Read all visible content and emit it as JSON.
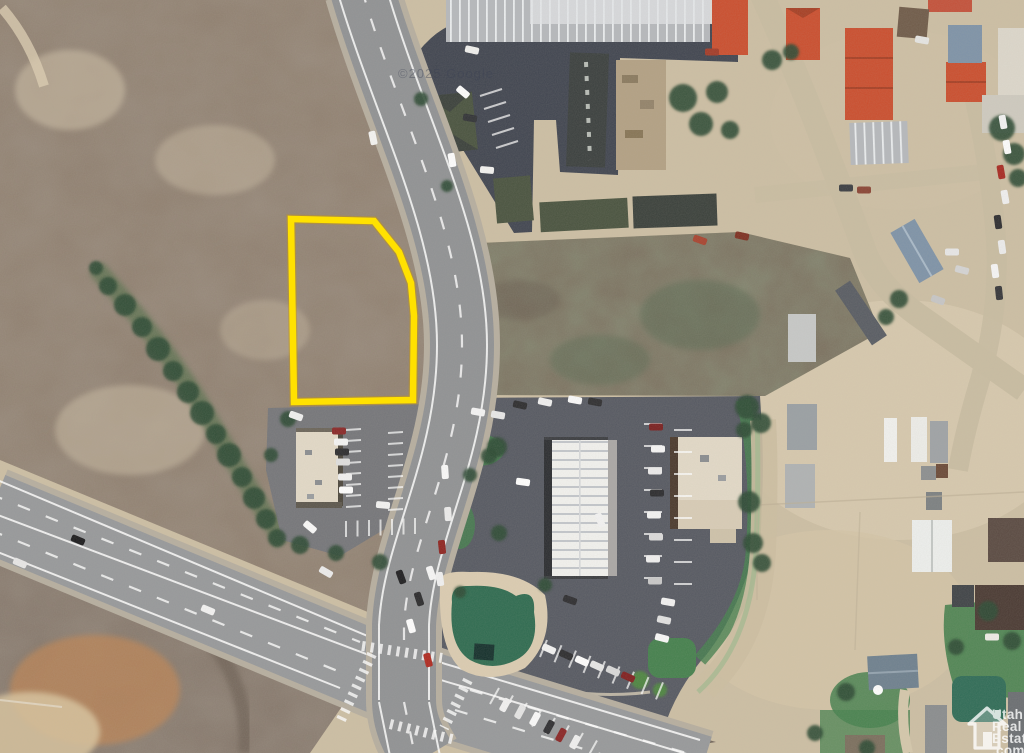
{
  "meta": {
    "type": "satellite-aerial-photo",
    "description": "Aerial real-estate listing photo of a small town: vacant lot outlined in yellow beside a curving main street, a divided highway at lower left, commercial buildings and red-roofed structures"
  },
  "colors": {
    "base_dirt": "#cdbfa4",
    "dirt_bright": "#dccdb2",
    "scrub": "#8f7f6f",
    "orange_dirt": "#bc8455",
    "road_asphalt": "#909294",
    "road_shoulder": "#b7afa0",
    "asphalt_dark": "#404550",
    "asphalt_mid": "#565962",
    "asphalt_light": "#75767a",
    "dirt_road": "#c9bda2",
    "grass": "#44804d",
    "pond_green": "#2e6b50",
    "tree_green": "#2c4a33",
    "tree_light": "#4e8a3e",
    "roof_red": "#cb4e2e",
    "roof_green": "#49533f",
    "roof_green_dark": "#3a403b",
    "roof_white": "#f2f1ed",
    "roof_tan": "#e3dac8",
    "roof_blue": "#7e93a8",
    "roof_gray": "#a9acab",
    "parcel_yellow": "#ffe100",
    "google_text": "#3c4254"
  },
  "parcel": {
    "points": "291,219 374,221 399,252 411,283 414,316 413,400 294,402",
    "stroke_color": "#ffe100",
    "stroke_width": 6.5
  },
  "watermarks": {
    "google": "©2025 Google",
    "ure": [
      "Utah",
      "Real",
      "Estate",
      ".com"
    ]
  },
  "scene": {
    "trees": [
      {
        "x": 683,
        "y": 98,
        "r": 14
      },
      {
        "x": 701,
        "y": 124,
        "r": 12
      },
      {
        "x": 717,
        "y": 92,
        "r": 11
      },
      {
        "x": 730,
        "y": 130,
        "r": 9
      },
      {
        "x": 772,
        "y": 60,
        "r": 10
      },
      {
        "x": 791,
        "y": 52,
        "r": 8
      },
      {
        "x": 1002,
        "y": 128,
        "r": 13
      },
      {
        "x": 1014,
        "y": 154,
        "r": 11
      },
      {
        "x": 1018,
        "y": 178,
        "r": 9
      },
      {
        "x": 96,
        "y": 268,
        "r": 7
      },
      {
        "x": 108,
        "y": 286,
        "r": 9
      },
      {
        "x": 125,
        "y": 305,
        "r": 11
      },
      {
        "x": 142,
        "y": 327,
        "r": 10
      },
      {
        "x": 158,
        "y": 349,
        "r": 12
      },
      {
        "x": 173,
        "y": 371,
        "r": 10
      },
      {
        "x": 188,
        "y": 392,
        "r": 11
      },
      {
        "x": 202,
        "y": 413,
        "r": 12
      },
      {
        "x": 216,
        "y": 434,
        "r": 10
      },
      {
        "x": 229,
        "y": 455,
        "r": 12
      },
      {
        "x": 242,
        "y": 477,
        "r": 10
      },
      {
        "x": 254,
        "y": 498,
        "r": 11
      },
      {
        "x": 266,
        "y": 519,
        "r": 10
      },
      {
        "x": 277,
        "y": 538,
        "r": 9
      },
      {
        "x": 899,
        "y": 299,
        "r": 9
      },
      {
        "x": 886,
        "y": 317,
        "r": 8
      },
      {
        "x": 747,
        "y": 407,
        "r": 12
      },
      {
        "x": 761,
        "y": 423,
        "r": 10
      },
      {
        "x": 744,
        "y": 430,
        "r": 8
      },
      {
        "x": 749,
        "y": 502,
        "r": 11
      },
      {
        "x": 753,
        "y": 543,
        "r": 10
      },
      {
        "x": 762,
        "y": 563,
        "r": 9
      },
      {
        "x": 497,
        "y": 447,
        "r": 10
      },
      {
        "x": 489,
        "y": 456,
        "r": 8
      },
      {
        "x": 499,
        "y": 533,
        "r": 8
      },
      {
        "x": 470,
        "y": 475,
        "r": 7
      },
      {
        "x": 288,
        "y": 419,
        "r": 8
      },
      {
        "x": 300,
        "y": 545,
        "r": 9
      },
      {
        "x": 336,
        "y": 553,
        "r": 8
      },
      {
        "x": 380,
        "y": 562,
        "r": 8
      },
      {
        "x": 271,
        "y": 455,
        "r": 7
      },
      {
        "x": 421,
        "y": 99,
        "r": 7
      },
      {
        "x": 447,
        "y": 186,
        "r": 6
      },
      {
        "x": 988,
        "y": 611,
        "r": 10
      },
      {
        "x": 1012,
        "y": 641,
        "r": 9
      },
      {
        "x": 956,
        "y": 647,
        "r": 8
      },
      {
        "x": 846,
        "y": 692,
        "r": 9
      },
      {
        "x": 815,
        "y": 733,
        "r": 8
      },
      {
        "x": 867,
        "y": 748,
        "r": 8
      },
      {
        "x": 640,
        "y": 680,
        "r": 9,
        "l": 1
      },
      {
        "x": 660,
        "y": 690,
        "r": 7,
        "l": 1
      },
      {
        "x": 545,
        "y": 585,
        "r": 7
      },
      {
        "x": 460,
        "y": 592,
        "r": 6
      }
    ],
    "cars": [
      {
        "x": 373,
        "y": 138,
        "r": 78,
        "c": "#f5f5f3"
      },
      {
        "x": 445,
        "y": 472,
        "r": 86,
        "c": "#fafafa"
      },
      {
        "x": 448,
        "y": 514,
        "r": 86,
        "c": "#ededed"
      },
      {
        "x": 442,
        "y": 547,
        "r": 84,
        "c": "#8f2420"
      },
      {
        "x": 440,
        "y": 579,
        "r": 82,
        "c": "#f2f2f2"
      },
      {
        "x": 401,
        "y": 577,
        "r": 70,
        "c": "#1e1e20"
      },
      {
        "x": 431,
        "y": 573,
        "r": 72,
        "c": "#f8f8f8"
      },
      {
        "x": 419,
        "y": 599,
        "r": 72,
        "c": "#2a2a2c"
      },
      {
        "x": 411,
        "y": 626,
        "r": 74,
        "c": "#ffffff"
      },
      {
        "x": 428,
        "y": 660,
        "r": 76,
        "c": "#b02a20"
      },
      {
        "x": 78,
        "y": 540,
        "r": 23,
        "c": "#1b1b1d"
      },
      {
        "x": 208,
        "y": 610,
        "r": 23,
        "c": "#f4f4f4"
      },
      {
        "x": 20,
        "y": 563,
        "r": 23,
        "c": "#e8e8e8"
      },
      {
        "x": 472,
        "y": 50,
        "r": 12,
        "c": "#f1f1ef"
      },
      {
        "x": 463,
        "y": 92,
        "r": 40,
        "c": "#fdfdfd"
      },
      {
        "x": 470,
        "y": 118,
        "r": 10,
        "c": "#303236"
      },
      {
        "x": 487,
        "y": 170,
        "r": 5,
        "c": "#f4f4f2"
      },
      {
        "x": 452,
        "y": 160,
        "r": 80,
        "c": "#ffffff"
      },
      {
        "x": 712,
        "y": 52,
        "r": 0,
        "c": "#a33b28"
      },
      {
        "x": 700,
        "y": 240,
        "r": 20,
        "c": "#a8432f"
      },
      {
        "x": 742,
        "y": 236,
        "r": 12,
        "c": "#7e3021"
      },
      {
        "x": 656,
        "y": 427,
        "r": 0,
        "c": "#7a1f1f"
      },
      {
        "x": 658,
        "y": 449,
        "r": 0,
        "c": "#f7f7f7"
      },
      {
        "x": 655,
        "y": 471,
        "r": 0,
        "c": "#ececec"
      },
      {
        "x": 657,
        "y": 493,
        "r": 0,
        "c": "#2b2b2e"
      },
      {
        "x": 654,
        "y": 515,
        "r": 0,
        "c": "#f4f4f4"
      },
      {
        "x": 656,
        "y": 537,
        "r": 0,
        "c": "#dcdcdc"
      },
      {
        "x": 653,
        "y": 559,
        "r": 0,
        "c": "#f1f1f1"
      },
      {
        "x": 655,
        "y": 581,
        "r": 0,
        "c": "#c9c9c9"
      },
      {
        "x": 668,
        "y": 602,
        "r": 10,
        "c": "#f3f3f3"
      },
      {
        "x": 664,
        "y": 620,
        "r": 12,
        "c": "#e2e2e2"
      },
      {
        "x": 662,
        "y": 638,
        "r": 14,
        "c": "#fafafa"
      },
      {
        "x": 549,
        "y": 649,
        "r": 24,
        "c": "#f4f4f4"
      },
      {
        "x": 566,
        "y": 655,
        "r": 24,
        "c": "#2c2c2f"
      },
      {
        "x": 582,
        "y": 661,
        "r": 24,
        "c": "#ffffff"
      },
      {
        "x": 597,
        "y": 666,
        "r": 24,
        "c": "#e8e8e8"
      },
      {
        "x": 613,
        "y": 671,
        "r": 24,
        "c": "#dadada"
      },
      {
        "x": 628,
        "y": 677,
        "r": 24,
        "c": "#801f1f"
      },
      {
        "x": 523,
        "y": 482,
        "r": 8,
        "c": "#ffffff"
      },
      {
        "x": 600,
        "y": 520,
        "r": 70,
        "c": "#f4f4f4"
      },
      {
        "x": 570,
        "y": 600,
        "r": 20,
        "c": "#2d2d30"
      },
      {
        "x": 505,
        "y": 705,
        "r": -62,
        "c": "#f3f3f3"
      },
      {
        "x": 520,
        "y": 712,
        "r": -62,
        "c": "#e6e6e6"
      },
      {
        "x": 535,
        "y": 719,
        "r": -62,
        "c": "#fbfbfb"
      },
      {
        "x": 549,
        "y": 727,
        "r": -62,
        "c": "#2e2e31"
      },
      {
        "x": 561,
        "y": 735,
        "r": -62,
        "c": "#8a2525"
      },
      {
        "x": 575,
        "y": 742,
        "r": -62,
        "c": "#f1f1f1"
      },
      {
        "x": 478,
        "y": 412,
        "r": 10,
        "c": "#f6f6f6"
      },
      {
        "x": 498,
        "y": 415,
        "r": 10,
        "c": "#e9e9e9"
      },
      {
        "x": 520,
        "y": 405,
        "r": 12,
        "c": "#2c2c2e"
      },
      {
        "x": 545,
        "y": 402,
        "r": 12,
        "c": "#f1f1f1"
      },
      {
        "x": 575,
        "y": 400,
        "r": 10,
        "c": "#fbfbfb"
      },
      {
        "x": 595,
        "y": 402,
        "r": 10,
        "c": "#2e2e30"
      },
      {
        "x": 339,
        "y": 431,
        "r": 0,
        "c": "#8a2727"
      },
      {
        "x": 341,
        "y": 442,
        "r": 0,
        "c": "#f6f6f6"
      },
      {
        "x": 342,
        "y": 452,
        "r": 0,
        "c": "#2c2c2f"
      },
      {
        "x": 343,
        "y": 462,
        "r": 0,
        "c": "#e0e0e0"
      },
      {
        "x": 345,
        "y": 477,
        "r": 0,
        "c": "#f2f2f2"
      },
      {
        "x": 346,
        "y": 490,
        "r": 0,
        "c": "#ffffff"
      },
      {
        "x": 383,
        "y": 505,
        "r": 5,
        "c": "#f4f4f4"
      },
      {
        "x": 310,
        "y": 527,
        "r": 40,
        "c": "#fafafa"
      },
      {
        "x": 296,
        "y": 416,
        "r": 20,
        "c": "#f1f1f1"
      },
      {
        "x": 326,
        "y": 572,
        "r": 30,
        "c": "#ededed"
      },
      {
        "x": 1003,
        "y": 122,
        "r": 80,
        "c": "#f4f4f4"
      },
      {
        "x": 1007,
        "y": 147,
        "r": 80,
        "c": "#fdfdfd"
      },
      {
        "x": 1001,
        "y": 172,
        "r": 80,
        "c": "#a82a22"
      },
      {
        "x": 1005,
        "y": 197,
        "r": 80,
        "c": "#f1f1f1"
      },
      {
        "x": 998,
        "y": 222,
        "r": 82,
        "c": "#2d2d30"
      },
      {
        "x": 1002,
        "y": 247,
        "r": 82,
        "c": "#ededed"
      },
      {
        "x": 995,
        "y": 271,
        "r": 82,
        "c": "#f7f7f7"
      },
      {
        "x": 999,
        "y": 293,
        "r": 84,
        "c": "#35363a"
      },
      {
        "x": 952,
        "y": 252,
        "r": 0,
        "c": "#e8e8e8"
      },
      {
        "x": 962,
        "y": 270,
        "r": 15,
        "c": "#d5d5d5"
      },
      {
        "x": 938,
        "y": 300,
        "r": 20,
        "c": "#c7c7c7"
      },
      {
        "x": 864,
        "y": 190,
        "r": 0,
        "c": "#8a4434"
      },
      {
        "x": 846,
        "y": 188,
        "r": 0,
        "c": "#3a3d42"
      },
      {
        "x": 992,
        "y": 637,
        "r": 0,
        "c": "#eeece6"
      },
      {
        "x": 922,
        "y": 40,
        "r": 10,
        "c": "#e6e6e4"
      }
    ],
    "stripes": [
      {
        "x": 644,
        "y": 424,
        "dx": 0,
        "dy": 22,
        "n": 8,
        "tx": 18,
        "ty": 0
      },
      {
        "x": 674,
        "y": 430,
        "dx": 0,
        "dy": 22,
        "n": 8,
        "tx": 18,
        "ty": 0
      },
      {
        "x": 540,
        "y": 657,
        "dx": 14.5,
        "dy": 5.3,
        "n": 9,
        "tx": 7,
        "ty": -17
      },
      {
        "x": 490,
        "y": 704,
        "dx": 14,
        "dy": 7.5,
        "n": 8,
        "tx": 9,
        "ty": -16
      },
      {
        "x": 480,
        "y": 96,
        "dx": 4,
        "dy": 13,
        "n": 5,
        "tx": 22,
        "ty": -7
      },
      {
        "x": 346,
        "y": 430,
        "dx": 0,
        "dy": 11,
        "n": 8,
        "tx": 15,
        "ty": -1
      },
      {
        "x": 388,
        "y": 433,
        "dx": 0,
        "dy": 11,
        "n": 8,
        "tx": 15,
        "ty": -1
      },
      {
        "x": 346,
        "y": 521,
        "dx": 11.5,
        "dy": -0.5,
        "n": 7,
        "tx": 0,
        "ty": 16
      }
    ]
  }
}
